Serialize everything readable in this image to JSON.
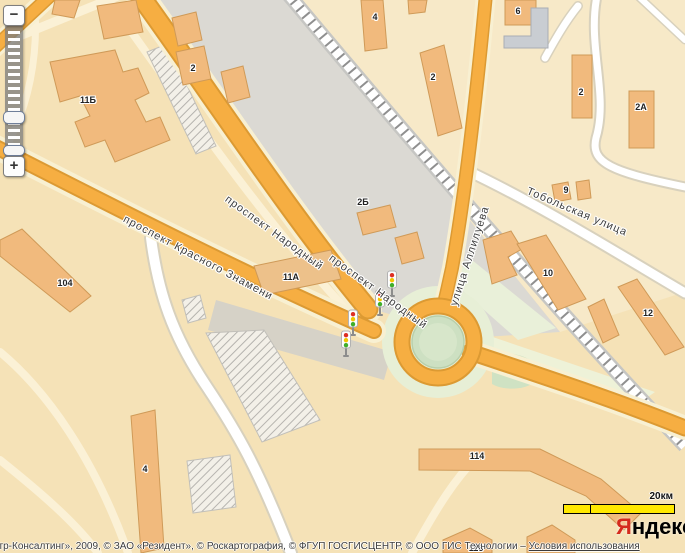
{
  "zoom_control": {
    "zoom_out_label": "−",
    "zoom_in_label": "+"
  },
  "streets": [
    {
      "name": "проспект Народный"
    },
    {
      "name": "проспект Народный"
    },
    {
      "name": "проспект Красного Знамени"
    },
    {
      "name": "Тобольская улица"
    },
    {
      "name": "улица Аллилуева"
    }
  ],
  "buildings": [
    {
      "number": "11Б"
    },
    {
      "number": "2"
    },
    {
      "number": "4"
    },
    {
      "number": "2"
    },
    {
      "number": "6"
    },
    {
      "number": "2А"
    },
    {
      "number": "2"
    },
    {
      "number": "9"
    },
    {
      "number": "2Б"
    },
    {
      "number": "10"
    },
    {
      "number": "104"
    },
    {
      "number": "11А"
    },
    {
      "number": "12"
    },
    {
      "number": "4"
    },
    {
      "number": "114"
    },
    {
      "number": "116"
    }
  ],
  "scale_bar": {
    "label": "20км"
  },
  "logo": {
    "brand_first_letter": "Я",
    "brand_rest": "ндекс"
  },
  "attribution": {
    "text": "нтр-Консалтинг», 2009, © ЗАО «Резидент», © Роскартография, © ФГУП ГОСГИСЦЕНТР, © ООО ГИС Технологии – ",
    "link_label": "Условия использования"
  },
  "icons": {
    "traffic_light": "traffic-light-icon"
  },
  "colors": {
    "road_major": "#f6ae42",
    "road_border": "#dc9a33",
    "building": "#f1ba7d",
    "building_border": "#cf9a58",
    "industrial_zone": "#dbd9d3",
    "green_area": "#e7efd6",
    "scale_bar": "#ffe800",
    "logo_accent": "#d52b1e",
    "railway_tie": "#8f8f8f"
  }
}
